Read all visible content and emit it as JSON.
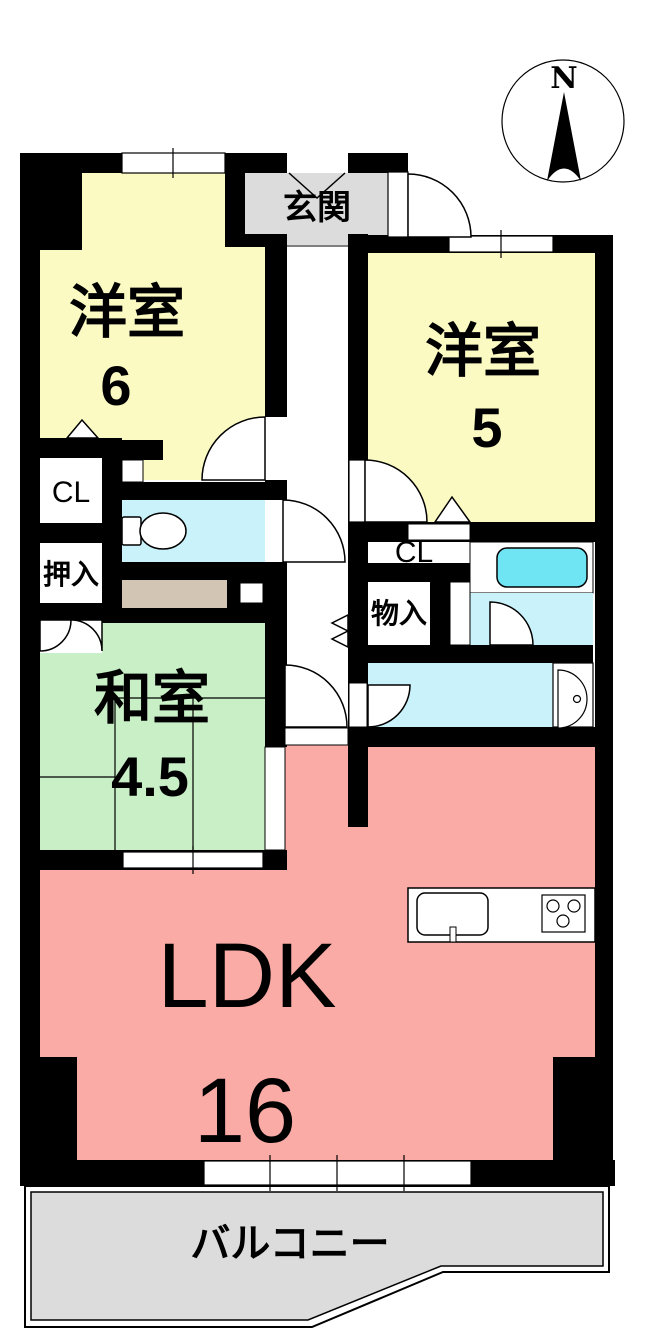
{
  "compass": {
    "north_label": "N"
  },
  "rooms": {
    "entrance": {
      "label": "玄関"
    },
    "western1": {
      "label": "洋室",
      "size": "6"
    },
    "western2": {
      "label": "洋室",
      "size": "5"
    },
    "japanese": {
      "label": "和室",
      "size": "4.5"
    },
    "ldk": {
      "label": "LDK",
      "size": "16"
    },
    "balcony": {
      "label": "バルコニー"
    },
    "closet_left": {
      "label": "CL"
    },
    "oshiire": {
      "label": "押入"
    },
    "closet_right": {
      "label": "CL"
    },
    "storage": {
      "label": "物入"
    }
  },
  "colors": {
    "wall": "#000000",
    "room_yellow": "#FBFAC3",
    "room_green": "#C8EFC5",
    "room_pink": "#FBABA6",
    "room_cyan": "#C9F2FB",
    "tub_cyan": "#6FE5F4",
    "tan": "#D3C5B3",
    "gray": "#DCDCDC"
  }
}
